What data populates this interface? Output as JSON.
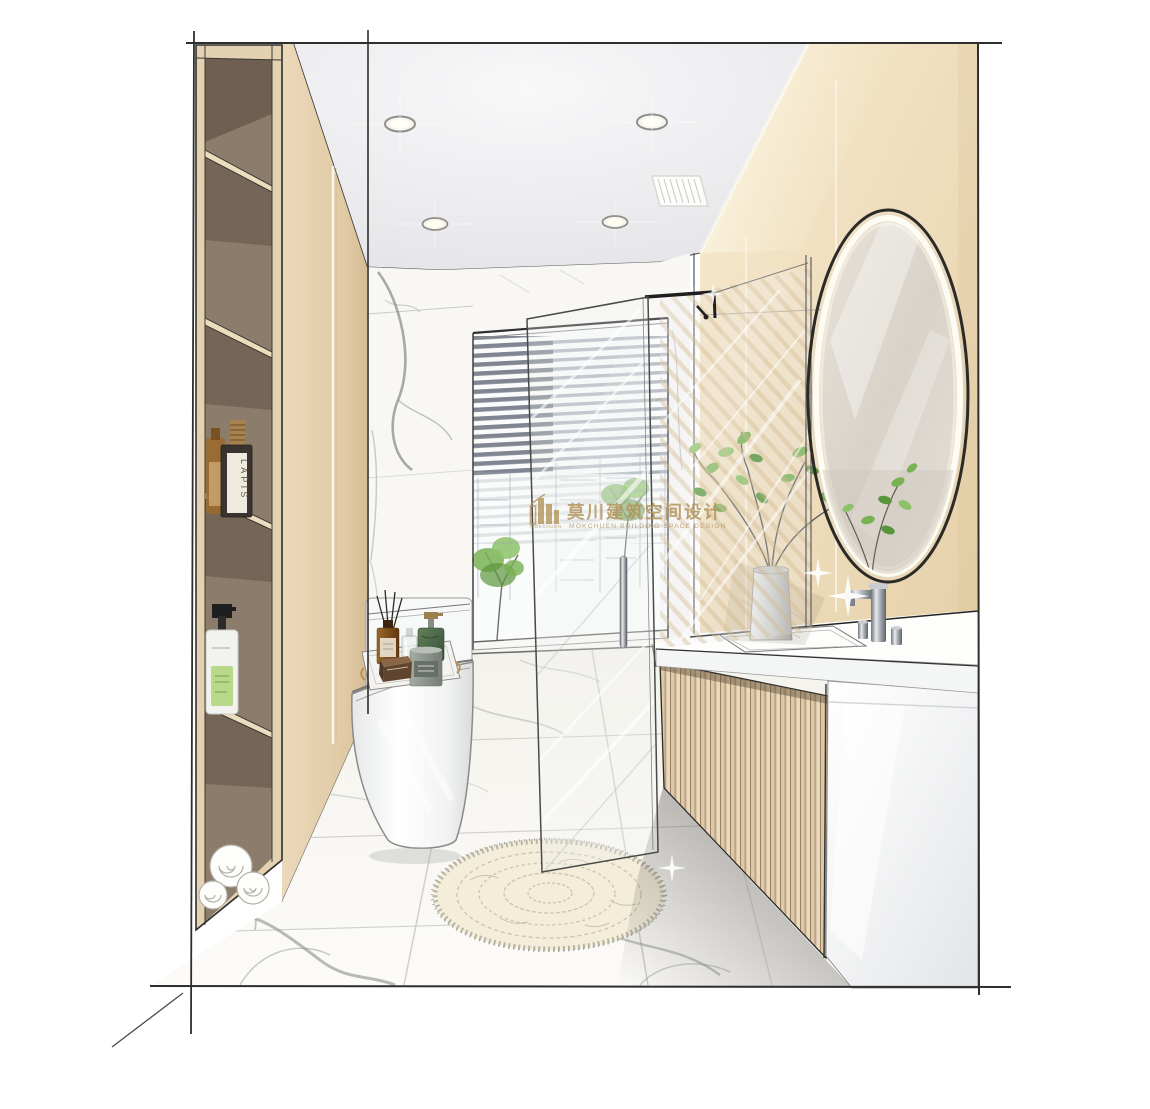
{
  "image": {
    "kind": "interior-design hand-drawn rendering",
    "room": "bathroom",
    "width_px": 1150,
    "height_px": 1109
  },
  "watermark": {
    "logo_text": "MOKCHUEN",
    "company_zh": "莫川建筑空间设计",
    "company_en": "MOKCHUEN BUILDING SPACE DESIGN",
    "color": "#b3955c"
  },
  "labels": {
    "spirits_bottle": "LAPIS"
  },
  "palette": {
    "wall_beige_left": "#e8d5b4",
    "wall_beige_right": "#eedcbb",
    "cabinet_beige": "#e4d1b1",
    "cabinet_interior": "#8c7c6b",
    "ceiling_gray": "#ececee",
    "marble_white": "#f8f7f3",
    "marble_vein": "#85897f",
    "wood_slat": "#d8c3a2",
    "watermark_gold": "#b3955c",
    "plant_green": "#79b254",
    "rug_cream": "#f3edda",
    "chrome": "#9aa0a6"
  },
  "scene": {
    "ceiling": {
      "downlights": 4,
      "vent_grilles": 1
    },
    "left_shelving": {
      "compartments": 5,
      "items": [
        "amber bottle",
        "dark LAPIS bottle",
        "white pump bottle with green label",
        "rolled white towels"
      ]
    },
    "toilet_tray_items": [
      "black reed diffuser sticks",
      "amber diffuser bottle",
      "clear glass bottle",
      "green stone soap pump",
      "gray candle",
      "brown soap bar"
    ],
    "fixtures": [
      "oval LED mirror",
      "floating vanity with wood-slat front",
      "tall chrome basin faucet",
      "walk-in glass shower",
      "one-piece toilet",
      "round cream shag rug",
      "window with venetian blinds",
      "green plant on counter"
    ]
  }
}
